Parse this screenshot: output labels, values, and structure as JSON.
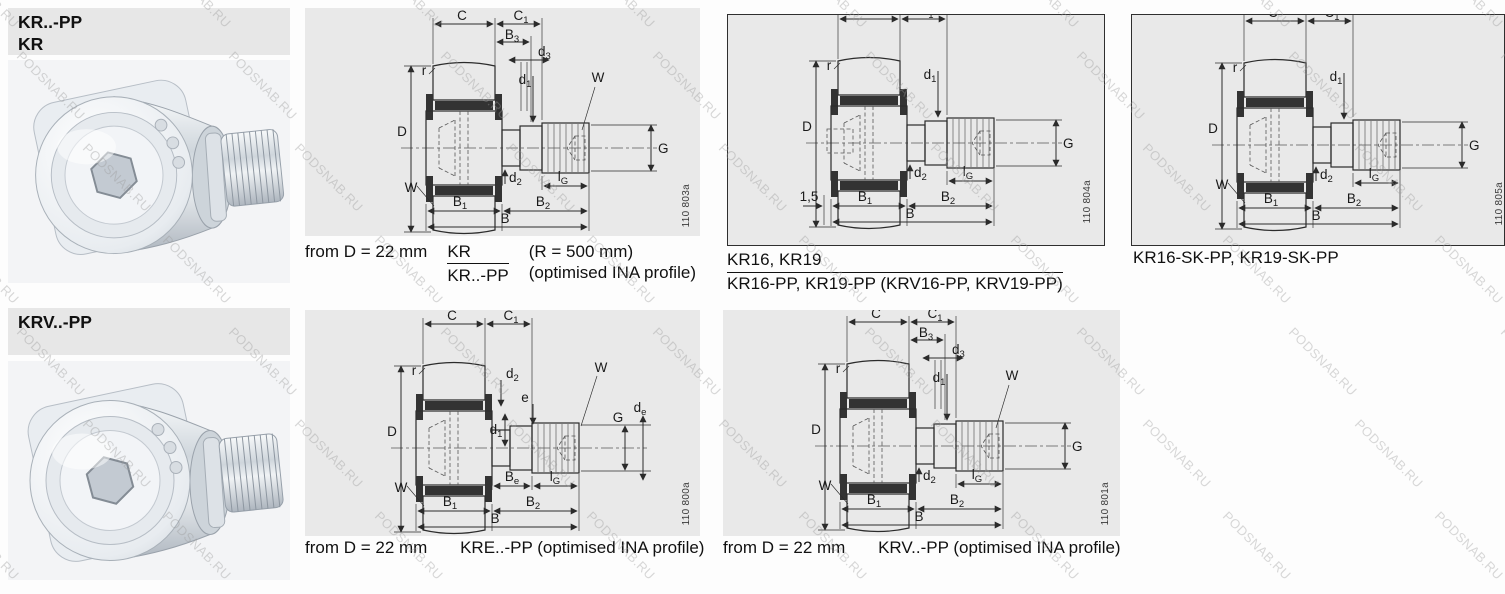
{
  "watermark": {
    "text": "PODSNAB.RU"
  },
  "colors": {
    "panel_bg": "#e9e9e9",
    "header_bg": "#e7e7e7",
    "photo_bg": "#f3f4f6",
    "line": "#2b2b2b"
  },
  "headers": {
    "kr_line1": "KR..-PP",
    "kr_line2": "KR",
    "krv": "KRV..-PP"
  },
  "dim_labels": {
    "C": {
      "m": "C",
      "s": ""
    },
    "C1": {
      "m": "C",
      "s": "1"
    },
    "B3": {
      "m": "B",
      "s": "3"
    },
    "d3": {
      "m": "d",
      "s": "3"
    },
    "d1": {
      "m": "d",
      "s": "1"
    },
    "d2": {
      "m": "d",
      "s": "2"
    },
    "B1": {
      "m": "B",
      "s": "1"
    },
    "B2": {
      "m": "B",
      "s": "2"
    },
    "B": {
      "m": "B",
      "s": ""
    },
    "lG": {
      "m": "l",
      "s": "G"
    },
    "Be": {
      "m": "B",
      "s": "e"
    },
    "de": {
      "m": "d",
      "s": "e"
    },
    "e": {
      "m": "e",
      "s": ""
    },
    "W": {
      "m": "W",
      "s": ""
    },
    "r": {
      "m": "r",
      "s": ""
    },
    "D": {
      "m": "D",
      "s": ""
    },
    "G": {
      "m": "G",
      "s": ""
    },
    "chamfer15": {
      "m": "1,5",
      "s": ""
    }
  },
  "drawing_numbers": {
    "kr": "110 803a",
    "kr16": "110 804a",
    "kr16sk": "110 805a",
    "kre": "110 800a",
    "krv": "110 801a"
  },
  "captions": {
    "kr": {
      "prefix": "from D = 22 mm",
      "frac_top": "KR",
      "frac_bottom": "KR..-PP",
      "note_top": "(R = 500 mm)",
      "note_bottom": "(optimised INA profile)"
    },
    "kr16": {
      "line1": "KR16, KR19",
      "line2": "KR16-PP, KR19-PP (KRV16-PP, KRV19-PP)"
    },
    "kr16sk": {
      "text": "KR16-SK-PP, KR19-SK-PP"
    },
    "kre": {
      "prefix": "from D = 22 mm",
      "text": "KRE..-PP (optimised INA profile)"
    },
    "krv": {
      "prefix": "from D = 22 mm",
      "text": "KRV..-PP (optimised INA profile)"
    }
  }
}
